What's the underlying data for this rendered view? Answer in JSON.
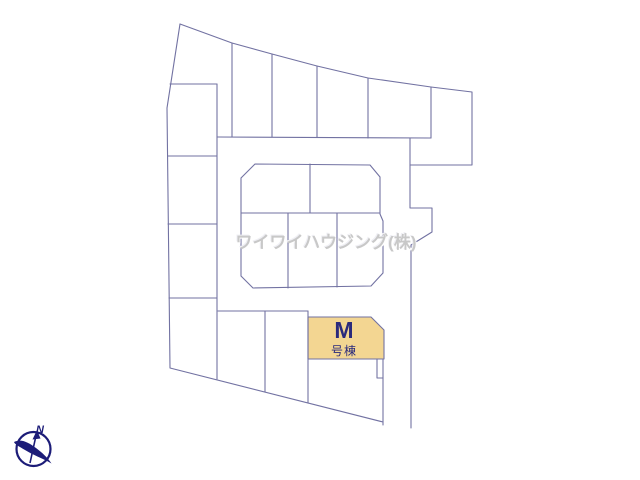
{
  "watermark": {
    "text": "ワイワイハウジング(株)",
    "color": "#c8c8c8"
  },
  "highlighted_unit": {
    "name": "M",
    "suffix": "号棟",
    "fill": "#F3D692",
    "text_color": "#2A2A7C"
  },
  "compass": {
    "label": "N",
    "color": "#1C1C78"
  },
  "map": {
    "line_color": "#7272A2",
    "background": "#ffffff",
    "segments": [
      [
        [
          180,
          24
        ],
        [
          232,
          43
        ],
        [
          272,
          54
        ],
        [
          317,
          66
        ],
        [
          368,
          78
        ],
        [
          431,
          87
        ],
        [
          472,
          92
        ],
        [
          472,
          165
        ],
        [
          410,
          165
        ],
        [
          410,
          208
        ],
        [
          432,
          208
        ],
        [
          432,
          232
        ],
        [
          411,
          245
        ],
        [
          411,
          428
        ]
      ],
      [
        [
          180,
          24
        ],
        [
          167,
          108
        ],
        [
          170,
          368
        ],
        [
          383,
          422
        ]
      ],
      [
        [
          383,
          359
        ],
        [
          383,
          425
        ]
      ],
      [
        [
          170,
          84
        ],
        [
          217,
          84
        ]
      ],
      [
        [
          217,
          84
        ],
        [
          217,
          379
        ]
      ],
      [
        [
          168,
          156
        ],
        [
          217,
          156
        ]
      ],
      [
        [
          168,
          224
        ],
        [
          217,
          224
        ]
      ],
      [
        [
          169,
          298
        ],
        [
          217,
          298
        ]
      ],
      [
        [
          217,
          137
        ],
        [
          431,
          138
        ]
      ],
      [
        [
          232,
          43
        ],
        [
          232,
          137
        ]
      ],
      [
        [
          272,
          54
        ],
        [
          272,
          137
        ]
      ],
      [
        [
          317,
          66
        ],
        [
          317,
          137
        ]
      ],
      [
        [
          368,
          78
        ],
        [
          368,
          138
        ]
      ],
      [
        [
          431,
          87
        ],
        [
          431,
          138
        ]
      ],
      [
        [
          410,
          138
        ],
        [
          410,
          165
        ]
      ],
      [
        [
          218,
          311
        ],
        [
          308,
          311
        ]
      ],
      [
        [
          265,
          311
        ],
        [
          265,
          392
        ]
      ],
      [
        [
          308,
          311
        ],
        [
          308,
          403
        ]
      ],
      [
        [
          377,
          359
        ],
        [
          377,
          378
        ],
        [
          383,
          378
        ]
      ],
      [
        [
          241,
          213
        ],
        [
          380,
          213
        ]
      ],
      [
        [
          310,
          164
        ],
        [
          310,
          213
        ]
      ],
      [
        [
          288,
          213
        ],
        [
          288,
          288
        ]
      ],
      [
        [
          337,
          213
        ],
        [
          337,
          287
        ]
      ]
    ],
    "polygons": [
      {
        "name": "center-block-outline",
        "fill": "none",
        "points": [
          [
            255,
            164
          ],
          [
            370,
            165
          ],
          [
            380,
            177
          ],
          [
            380,
            214
          ],
          [
            383,
            221
          ],
          [
            383,
            273
          ],
          [
            371,
            286
          ],
          [
            253,
            288
          ],
          [
            241,
            276
          ],
          [
            241,
            178
          ]
        ]
      },
      {
        "name": "unit-m-parcel",
        "fill": "#F3D692",
        "points": [
          [
            308,
            317
          ],
          [
            371,
            317
          ],
          [
            384,
            330
          ],
          [
            384,
            359
          ],
          [
            308,
            359
          ]
        ]
      }
    ]
  }
}
